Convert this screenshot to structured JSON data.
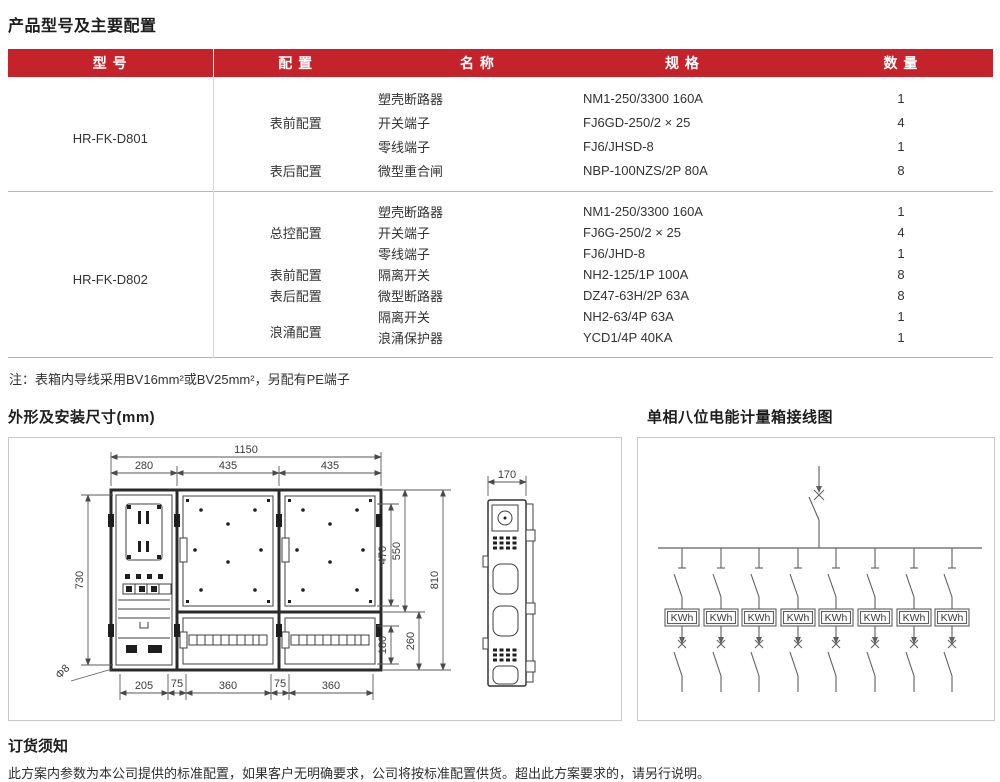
{
  "page": {
    "title": "产品型号及主要配置"
  },
  "colors": {
    "header_red": "#c4232b"
  },
  "table": {
    "headers": [
      "型 号",
      "配 置",
      "名 称",
      "规 格",
      "数 量"
    ],
    "groups": [
      {
        "model": "HR-FK-D801",
        "configs": [
          {
            "label": "表前配置",
            "items": [
              {
                "name": "塑壳断路器",
                "spec": "NM1-250/3300 160A",
                "qty": "1"
              },
              {
                "name": "开关端子",
                "spec": "FJ6GD-250/2 × 25",
                "qty": "4"
              },
              {
                "name": "零线端子",
                "spec": "FJ6/JHSD-8",
                "qty": "1"
              }
            ]
          },
          {
            "label": "表后配置",
            "items": [
              {
                "name": "微型重合闸",
                "spec": "NBP-100NZS/2P 80A",
                "qty": "8"
              }
            ]
          }
        ]
      },
      {
        "model": "HR-FK-D802",
        "configs": [
          {
            "label": "总控配置",
            "items": [
              {
                "name": "塑壳断路器",
                "spec": "NM1-250/3300 160A",
                "qty": "1"
              },
              {
                "name": "开关端子",
                "spec": "FJ6G-250/2 × 25",
                "qty": "4"
              },
              {
                "name": "零线端子",
                "spec": "FJ6/JHD-8",
                "qty": "1"
              }
            ]
          },
          {
            "label": "表前配置",
            "items": [
              {
                "name": "隔离开关",
                "spec": "NH2-125/1P 100A",
                "qty": "8"
              }
            ]
          },
          {
            "label": "表后配置",
            "items": [
              {
                "name": "微型断路器",
                "spec": "DZ47-63H/2P 63A",
                "qty": "8"
              }
            ]
          },
          {
            "label": "浪涌配置",
            "items": [
              {
                "name": "隔离开关",
                "spec": "NH2-63/4P 63A",
                "qty": "1"
              },
              {
                "name": "浪涌保护器",
                "spec": "YCD1/4P 40KA",
                "qty": "1"
              }
            ]
          }
        ]
      }
    ]
  },
  "note": "注：表箱内导线采用BV16mm²或BV25mm²，另配有PE端子",
  "drawing": {
    "title": "外形及安装尺寸(mm)",
    "overall_width": "1150",
    "top_dims": [
      "280",
      "435",
      "435"
    ],
    "left_dim": "730",
    "right_dims": [
      "470",
      "550",
      "810"
    ],
    "lower_right_dims": [
      "180",
      "260"
    ],
    "bottom_dims": [
      "205",
      "75",
      "360",
      "75",
      "360"
    ],
    "hole_label": "Φ8",
    "side_width": "170"
  },
  "wiring": {
    "title": "单相八位电能计量箱接线图",
    "meter_label": "KWh",
    "branch_count": 8
  },
  "ordering": {
    "title": "订货须知",
    "text": "此方案内参数为本公司提供的标准配置，如果客户无明确要求，公司将按标准配置供货。超出此方案要求的，请另行说明。"
  }
}
